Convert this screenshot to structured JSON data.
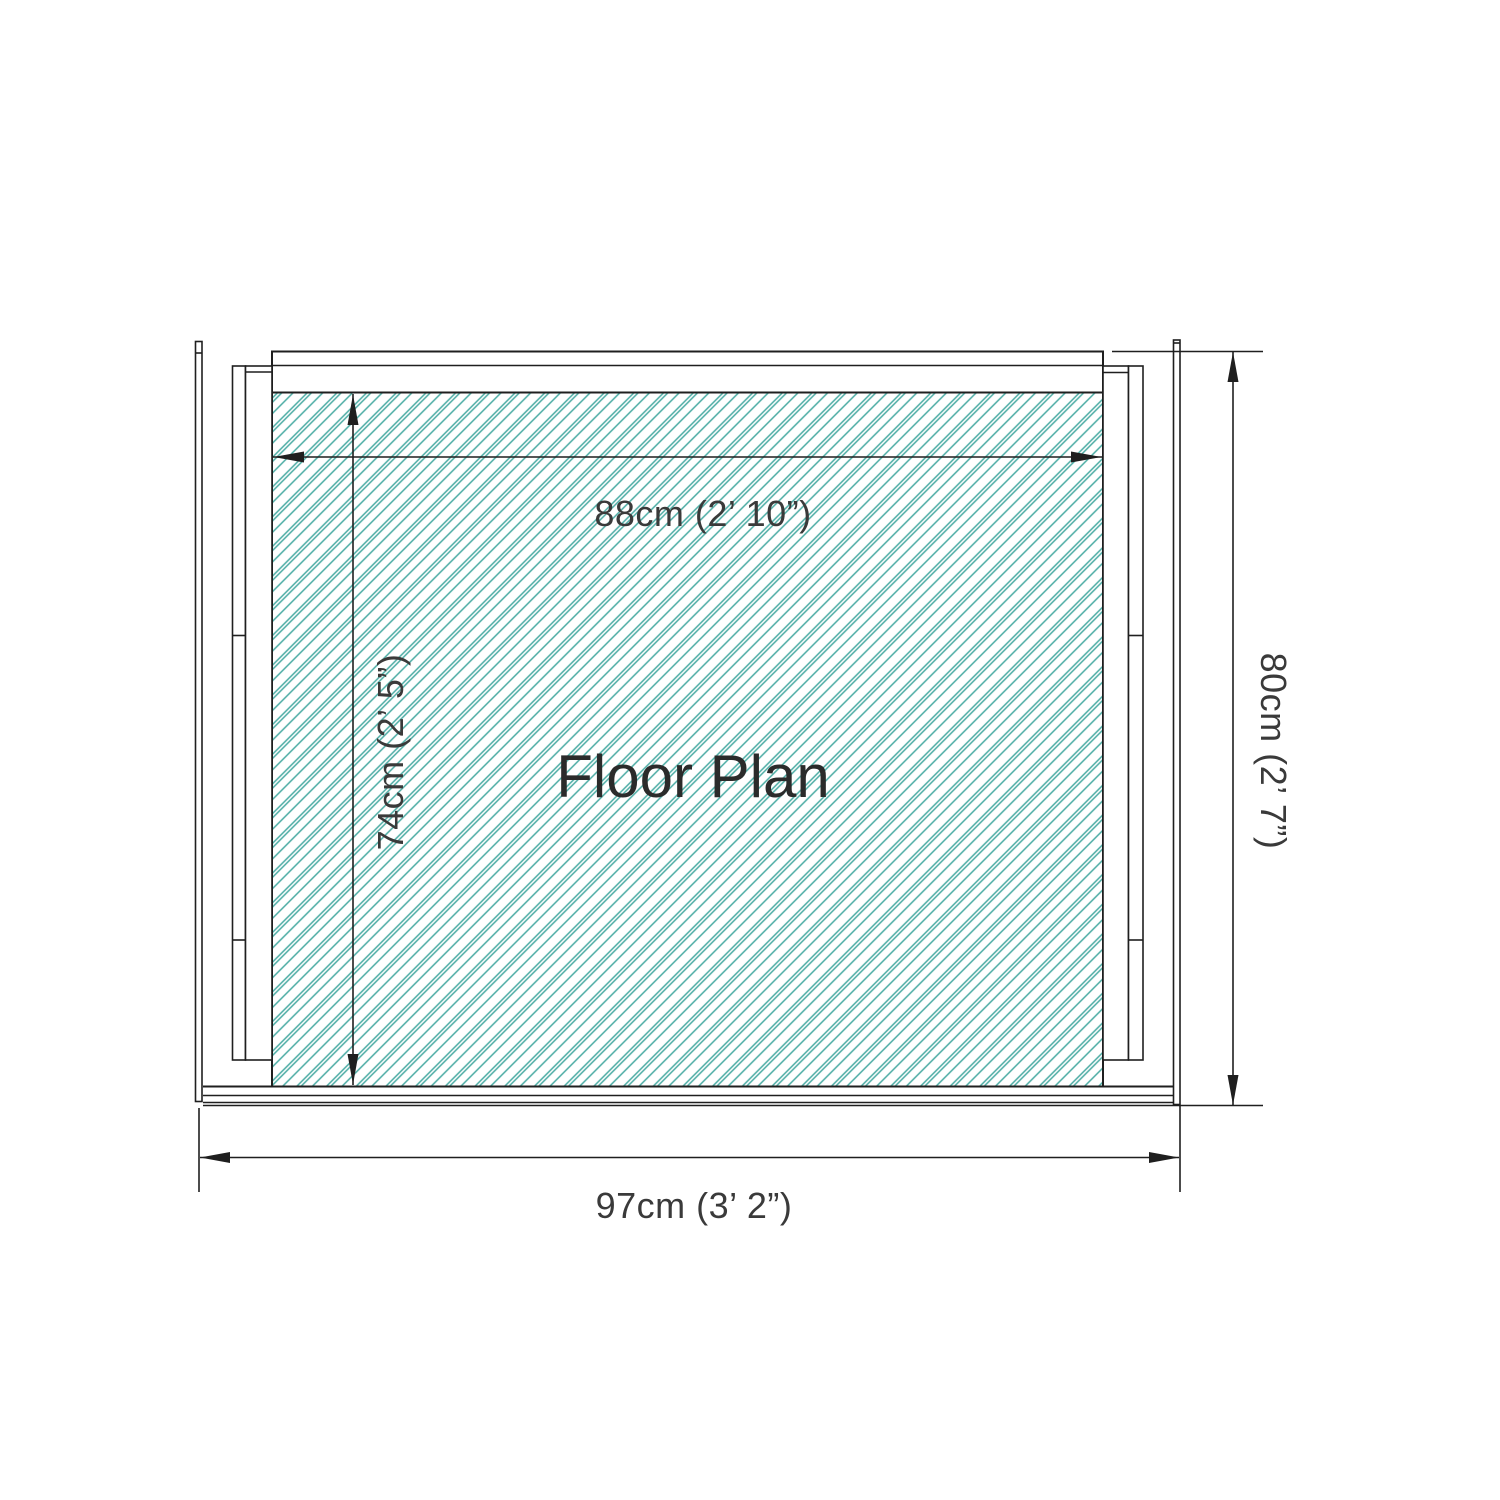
{
  "drawing": {
    "title": "Floor Plan",
    "colors": {
      "hatch": "#4aaba3",
      "wall_line": "#1f1f1f",
      "dim_line": "#1f1f1f",
      "text": "#3a3a3a",
      "title_text": "#2b2b2b",
      "wall_fill": "#ffffff",
      "background": "#ffffff"
    },
    "dimensions": {
      "interior_width": {
        "value_cm": 88,
        "imperial": "2’ 10”",
        "label": "88cm (2’ 10”)"
      },
      "interior_depth": {
        "value_cm": 74,
        "imperial": "2’ 5”",
        "label": "74cm (2’ 5”)"
      },
      "overall_width": {
        "value_cm": 97,
        "imperial": "3’ 2”",
        "label": "97cm (3’ 2”)"
      },
      "overall_depth": {
        "value_cm": 80,
        "imperial": "2’ 7”",
        "label": "80cm (2’ 7”)"
      }
    }
  }
}
